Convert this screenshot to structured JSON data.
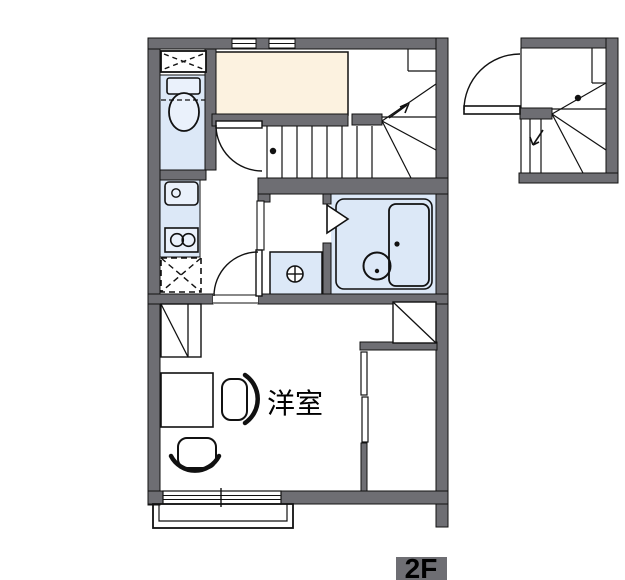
{
  "floor_label": "2F",
  "rooms": [
    {
      "name": "洋室",
      "type": "western-style-room"
    }
  ],
  "colors": {
    "wall_gray": "#6e6e73",
    "fixture_blue": "#dce8f7",
    "closet_cream": "#fcf2e0",
    "line_black": "#111111",
    "background": "#ffffff"
  },
  "fixtures": [
    "toilet",
    "storage-shelf",
    "kitchen-sink",
    "gas-stove-2-burner",
    "refrigerator-space",
    "washing-machine-pan",
    "unit-bath",
    "bathtub",
    "folding-bath-door",
    "staircase-with-winder",
    "up-arrow",
    "hall-doors",
    "closet-sliding-door",
    "desk",
    "chair",
    "chair",
    "balcony",
    "sliding-window",
    "detached-stair-detail"
  ]
}
